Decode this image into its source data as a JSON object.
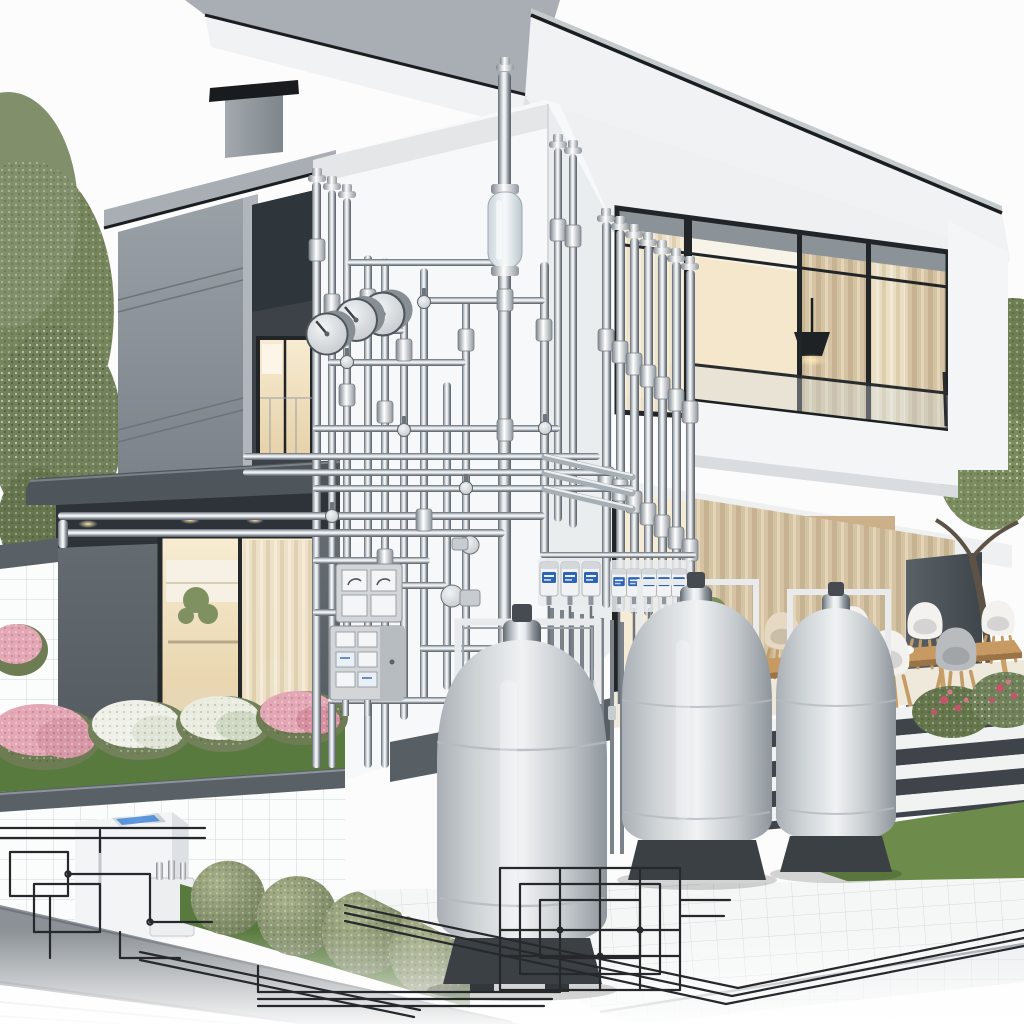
{
  "palette": {
    "sky": "#fcfcfd",
    "roof_slab": "#a8aeb3",
    "roof_white": "#f0f2f3",
    "roof_sliver": "#c5cacd",
    "roof_edge": "#1b1e20",
    "soffit": "#eef0f1",
    "tower": "#8e959b",
    "tower_light": "#b0b6bb",
    "recess": "#3c4248",
    "volume": "#5d646b",
    "soffit_shadow": "#2d3338",
    "facade": "#f7f8f9",
    "frame": "#222527",
    "glass_warm": "#f3e6ca",
    "glass_deep": "#e6d3b0",
    "curtain": "#d5c3a3",
    "curtain_light": "#ece1c8",
    "parapet": "#f4f5f6",
    "pillar": "#4a5156",
    "wood": "#c69a62",
    "wood_dark": "#9a7444",
    "chair_white": "#f3f2ef",
    "chair_beige": "#e6d8c2",
    "chair_gray": "#b8bcbf",
    "step": "#f1f2f2",
    "riser": "#3e444a",
    "grass": "#6d8c4b",
    "grass_dark": "#597a3e",
    "foliage": "#7a895d",
    "foliage_dark": "#5e6d45",
    "flower_pink": "#e4a7b5",
    "flower_white": "#eff1e9",
    "cap_gray": "#596066",
    "tile": "#fbfcfc",
    "tile_line": "#d2d6d9",
    "path_gray": "#8b9196",
    "tank_base": "#3b4045",
    "panel": "#d3d6d9",
    "meter_blue": "#2f63b4",
    "line_art": "#26292c",
    "appliance": "#f2f4f5",
    "screen_blue": "#3a7fd5",
    "glow": "#ffe9b8"
  },
  "scene": {
    "description": "Modern two-story house render with exposed chrome gas piping, dial gauges, meter racks, propane tanks and terrace, fading into blueprint line art at the base",
    "counts": {
      "gas_tanks": 3,
      "dial_gauges": 3,
      "gas_meter_units": 8,
      "electrical_panels": 2,
      "topiary_balls": 4,
      "dining_chairs": 7,
      "flower_bushes": 5,
      "ceiling_downlights": 6,
      "terrace_steps": 4,
      "trees": 2
    }
  }
}
